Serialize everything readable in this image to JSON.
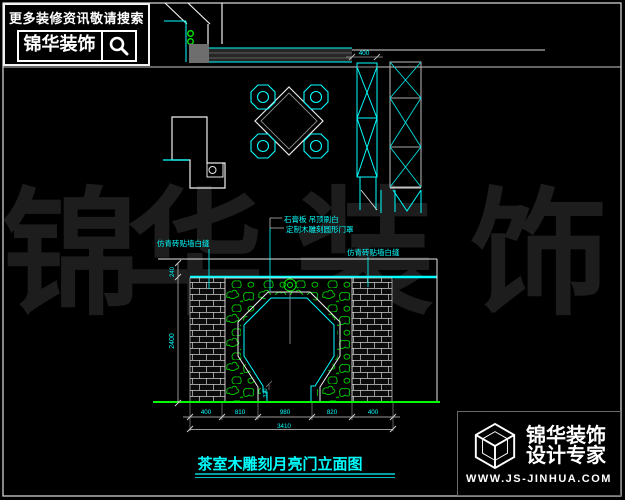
{
  "colors": {
    "line_cyan": "#00ffff",
    "floor_green": "#00ff00",
    "foliage_green": "#00cc00",
    "hinge_green": "#00ee00",
    "white": "#ffffff",
    "watermark_gray": "#1d1d1d",
    "background": "#000000"
  },
  "search_logo": {
    "tagline": "更多装修资讯敬请搜索",
    "brand": "锦华装饰",
    "icon": "magnifier"
  },
  "watermark": [
    "锦",
    "华",
    "装",
    "饰"
  ],
  "plan": {
    "cabinet_width_dim": "400"
  },
  "elevation": {
    "ann_ceiling": "石膏板 吊顶刷白",
    "ann_gate": "定制木雕刻圆形门罩",
    "ann_brick_left": "仿青砖贴墙白缝",
    "ann_brick_right": "仿青砖贴墙白缝",
    "dim_top": "240",
    "dim_height": "2400",
    "dim_foot": "320",
    "dim_segments": [
      "400",
      "810",
      "980",
      "820",
      "400"
    ],
    "dim_total": "3410"
  },
  "title": "茶室木雕刻月亮门立面图",
  "brand_logo": {
    "name": "锦华装饰",
    "slogan": "设计专家",
    "website": "WWW.JS-JINHUA.COM"
  }
}
